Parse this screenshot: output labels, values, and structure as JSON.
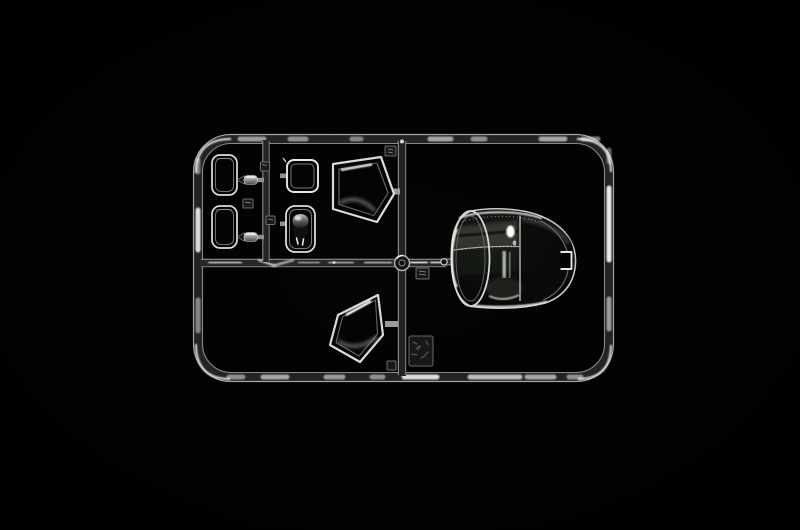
{
  "image": {
    "description": "Studio photograph of a clear (transparent) injection-molded model-kit sprue of glazing parts — small cab windows, a dome light lens, two angled side windows and one large curved windshield canopy — lit against a pure black background.",
    "subject": "clear parts sprue",
    "visible_text": ""
  },
  "colors": {
    "background": "#000000",
    "plastic_bright_edge": "#e8e8e8",
    "plastic_mid": "#9a9a9a",
    "plastic_core": "#232323",
    "glass_black": "#050505",
    "glass_sheen_olive": "#3a3d34",
    "specular_highlight": "#ffffff"
  },
  "parts": {
    "frame": "Sprue outer frame rail (rounded rectangle)",
    "runner_center": "Central vertical runner",
    "runner_middle": "Middle horizontal runner",
    "runner_left": "Left sub-runner",
    "junction_boss": "Round boss at runner junction",
    "window_rect_top": "Small rectangular window pane (upper left)",
    "window_rect_bottom": "Small rectangular window pane (lower left)",
    "lens_part_top": "Small cylindrical clear part (upper)",
    "lens_part_bottom": "Small cylindrical clear part (lower)",
    "window_square": "Square window pane",
    "dome_light": "Clear dome-light lens part",
    "window_quad_top": "Angled cab side window (upper)",
    "window_quad_bottom": "Angled cab side window (lower)",
    "canopy": "Large curved windshield / cab canopy",
    "canopy_notch": "Locating notch on canopy edge",
    "tags": "Embossed part-number tags on runners",
    "logo_plate": "Molded manufacturer logo plate"
  }
}
